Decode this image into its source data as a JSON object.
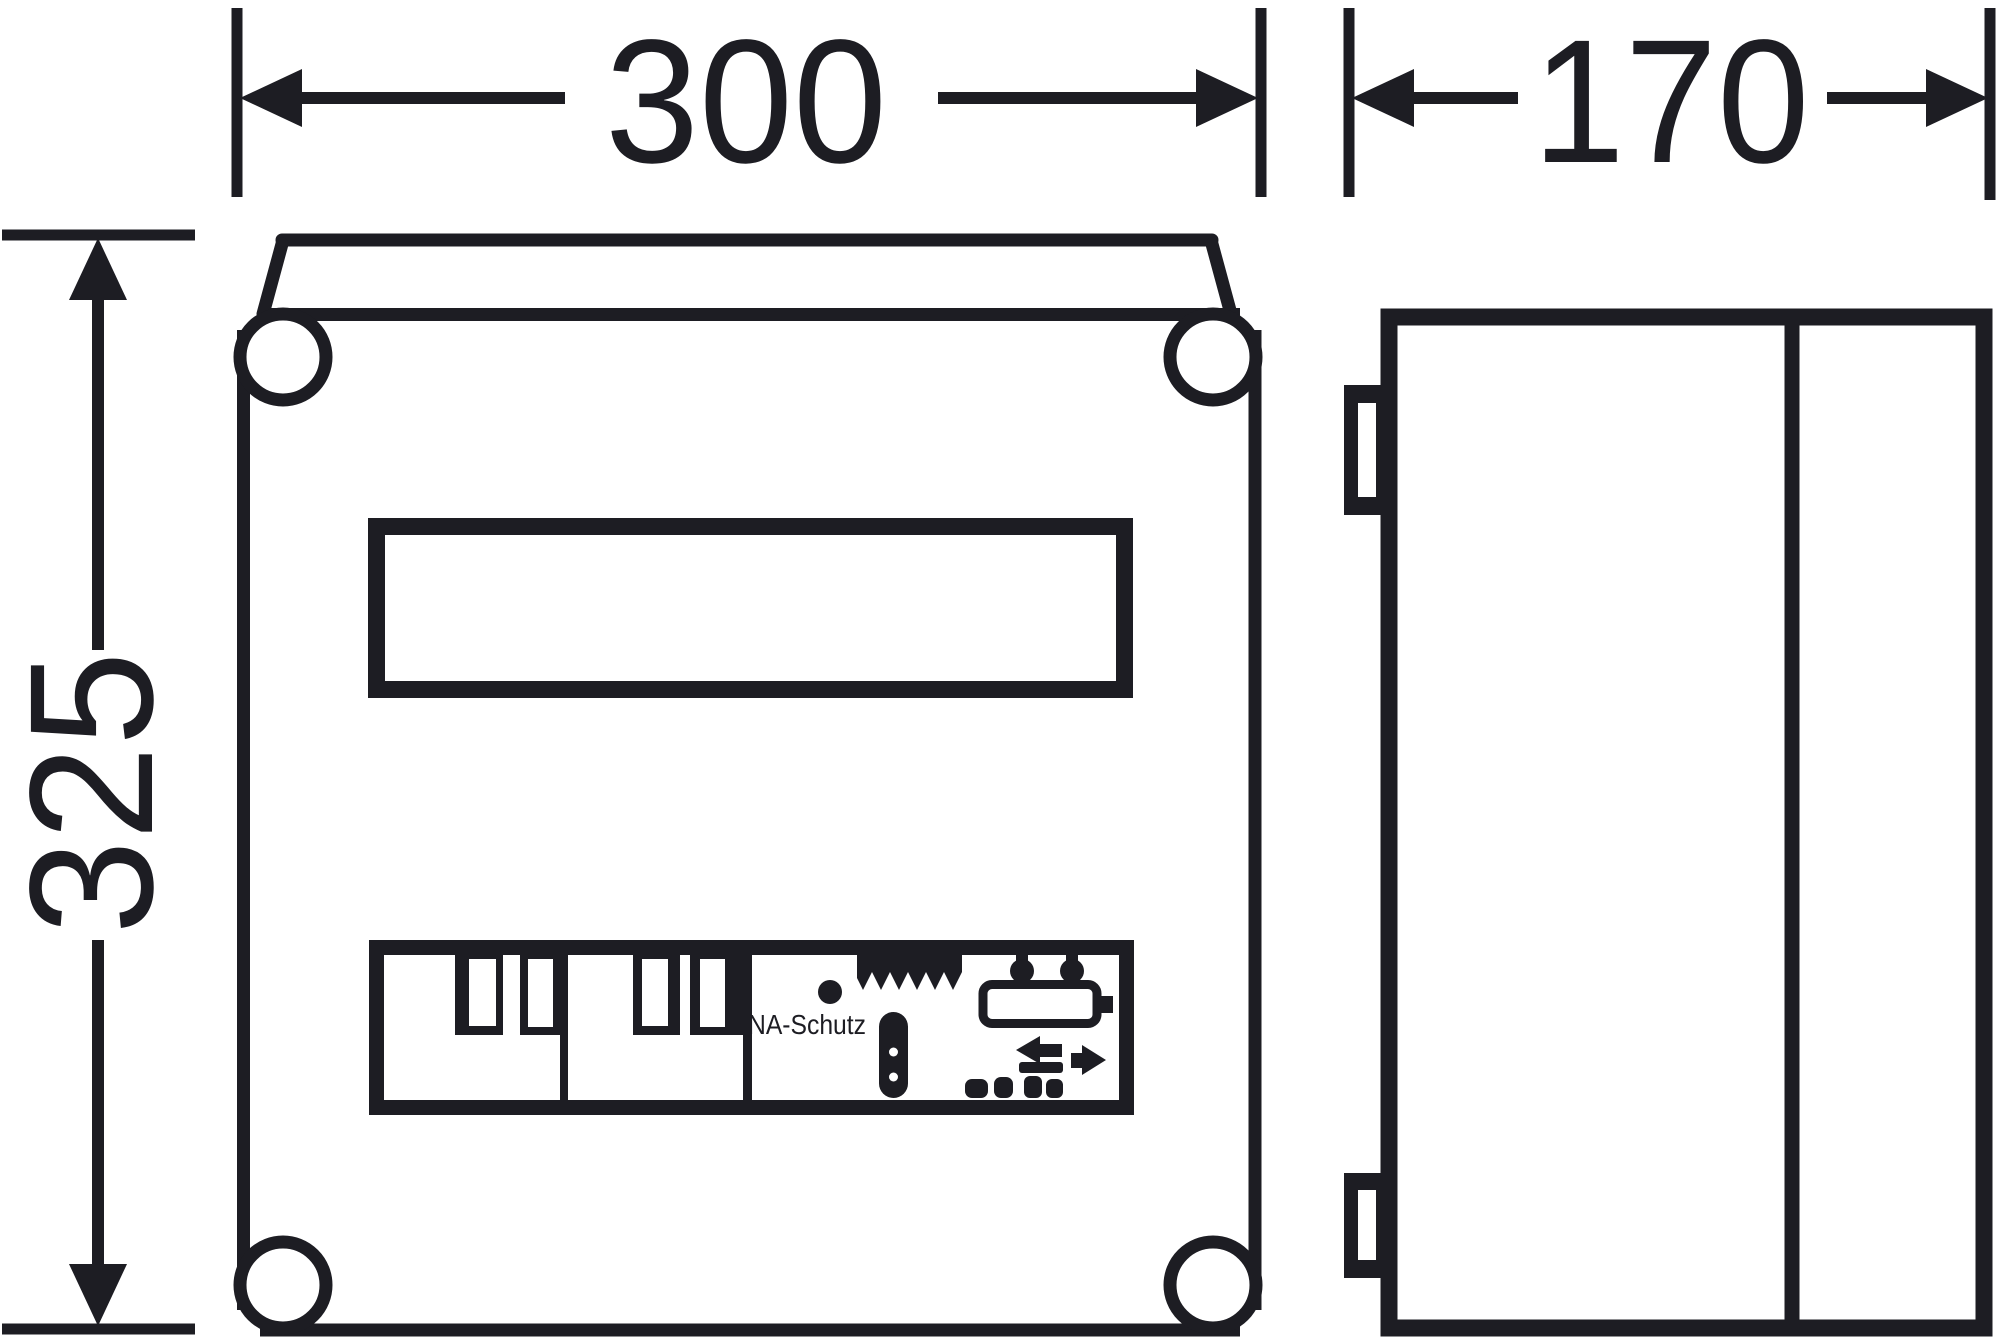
{
  "drawing": {
    "kind": "enclosure-dimension-drawing",
    "views": {
      "front_view": "front",
      "side_view": "side"
    },
    "dimensions": {
      "front_width": {
        "value": "300"
      },
      "side_depth": {
        "value": "170"
      },
      "front_height": {
        "value": "325"
      }
    },
    "front_view": {
      "din_section_label": "NA-Schutz"
    },
    "colors": {
      "ink": "#1d1d23",
      "background": "#ffffff"
    }
  }
}
